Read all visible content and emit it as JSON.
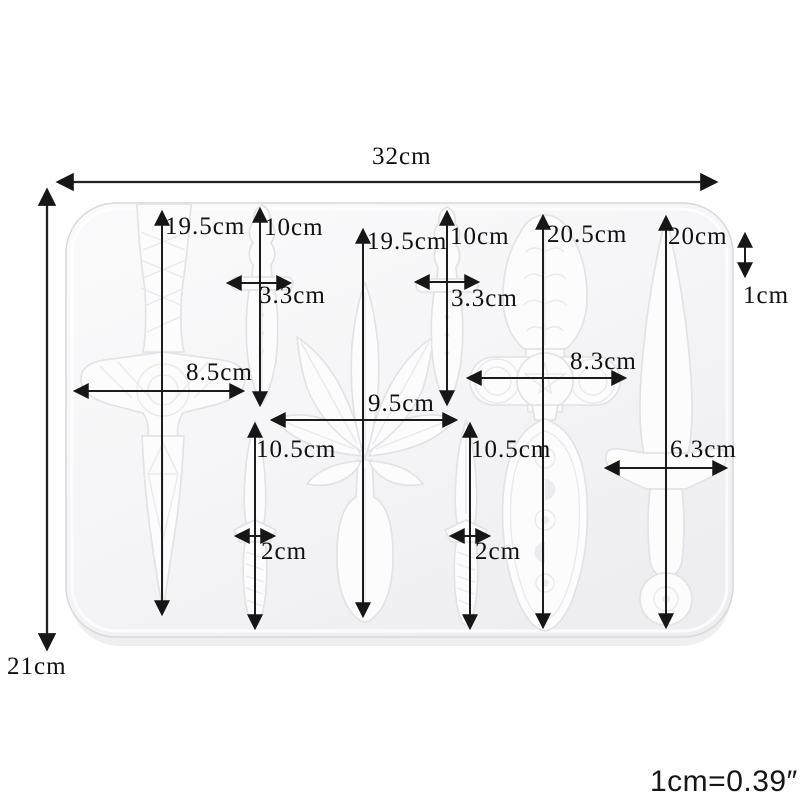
{
  "diagram": {
    "overall": {
      "width": "32cm",
      "height": "21cm",
      "edge_margin": "1cm"
    },
    "cavities": {
      "celtic_sword": {
        "length": "19.5cm",
        "guard_width": "8.5cm"
      },
      "dagger_left_handle": {
        "length": "10cm",
        "guard_width": "3.3cm"
      },
      "dagger_left_blade": {
        "length": "10.5cm",
        "width": "2cm"
      },
      "leaf": {
        "height": "19.5cm",
        "width": "9.5cm"
      },
      "dagger_right_handle": {
        "length": "10cm",
        "guard_width": "3.3cm"
      },
      "dagger_right_blade": {
        "length": "10.5cm",
        "width": "2cm"
      },
      "athame": {
        "length": "20.5cm",
        "guard_width": "8.3cm"
      },
      "knife": {
        "length": "20cm",
        "guard_width": "6.3cm"
      }
    },
    "unit_conversion": "1cm=0.39″"
  }
}
